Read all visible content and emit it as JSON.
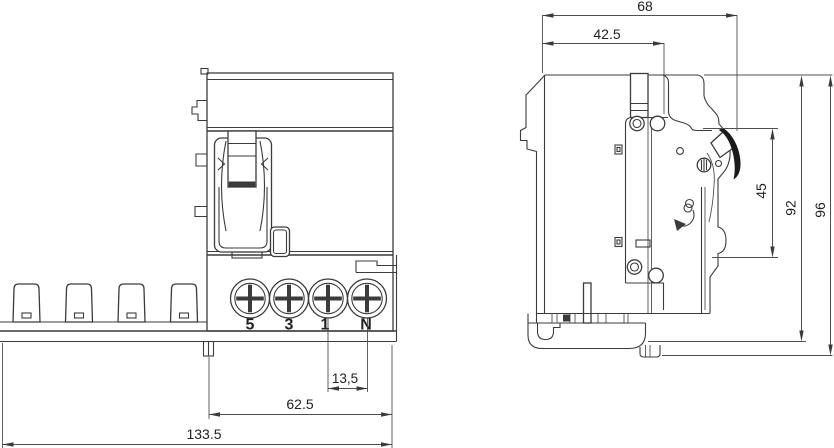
{
  "drawing": {
    "type": "technical-dimension-drawing",
    "views": [
      "front-view",
      "side-view"
    ]
  },
  "dimensions": {
    "top_depth": "68",
    "front_depth": "42.5",
    "handle_height": "45",
    "body_height": "92",
    "overall_height": "96",
    "terminal_pitch": "13,5",
    "module_width": "62.5",
    "overall_width": "133.5"
  },
  "terminals": [
    "5",
    "3",
    "1",
    "N"
  ],
  "colors": {
    "line": "#3b3b3b",
    "dimension_line": "#4f4f4f",
    "text": "#222222",
    "lever": "#1a1a1a",
    "background": "#ffffff"
  }
}
